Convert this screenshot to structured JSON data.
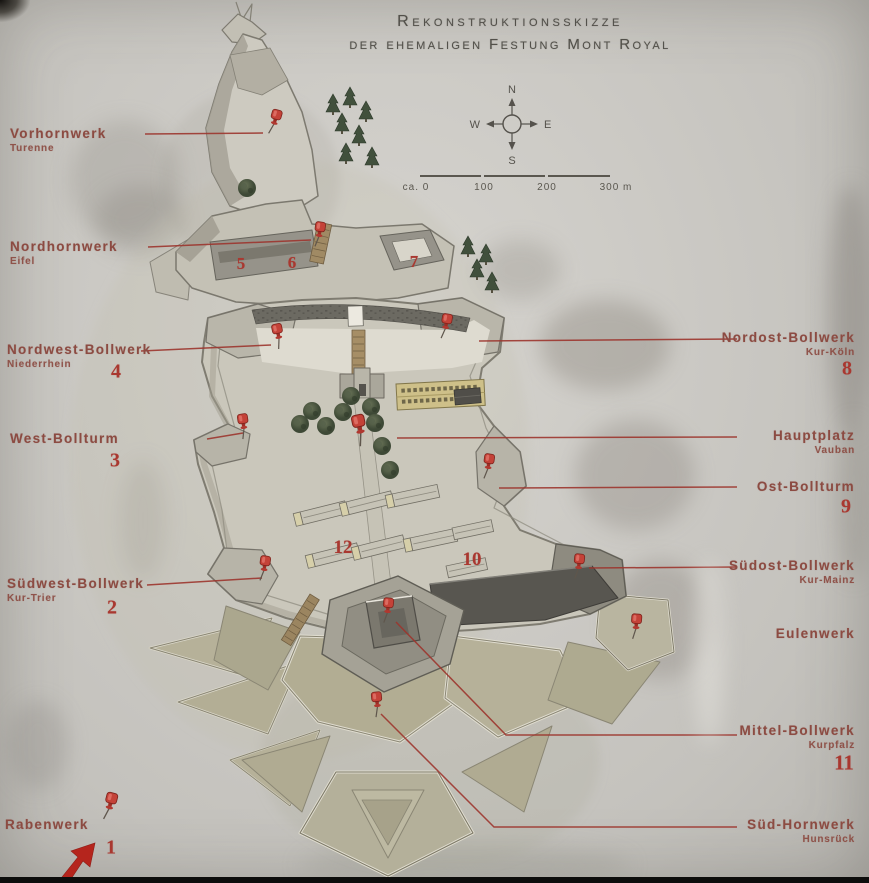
{
  "title": {
    "line1": "Rekonstruktionsskizze",
    "line2": "der ehemaligen Festung Mont Royal"
  },
  "compass": {
    "n": "N",
    "e": "E",
    "s": "S",
    "w": "W"
  },
  "scale": {
    "labels": [
      "ca. 0",
      "100",
      "200",
      "300 m"
    ]
  },
  "colors": {
    "annotation_red": "#9c352d",
    "number_red": "#a93830",
    "label_brick": "#8c4b42",
    "pin_red": "#c43a2e",
    "ink": "#52504a"
  },
  "annotations": {
    "labels": [
      {
        "text": "Vorhornwerk",
        "sub": "Turenne",
        "side": "left",
        "x": 10,
        "y": 126
      },
      {
        "text": "Nordhornwerk",
        "sub": "Eifel",
        "side": "left",
        "x": 10,
        "y": 239
      },
      {
        "text": "Nordwest-Bollwerk",
        "sub": "Niederrhein",
        "side": "left",
        "x": 7,
        "y": 342
      },
      {
        "text": "West-Bollturm",
        "sub": "",
        "side": "left",
        "x": 10,
        "y": 431
      },
      {
        "text": "Südwest-Bollwerk",
        "sub": "Kur-Trier",
        "side": "left",
        "x": 7,
        "y": 576
      },
      {
        "text": "Rabenwerk",
        "sub": "",
        "side": "left",
        "x": 5,
        "y": 817
      },
      {
        "text": "Nordost-Bollwerk",
        "sub": "Kur-Köln",
        "side": "right",
        "x": 855,
        "y": 330
      },
      {
        "text": "Hauptplatz",
        "sub": "Vauban",
        "side": "right",
        "x": 855,
        "y": 428
      },
      {
        "text": "Ost-Bollturm",
        "sub": "",
        "side": "right",
        "x": 855,
        "y": 479
      },
      {
        "text": "Südost-Bollwerk",
        "sub": "Kur-Mainz",
        "side": "right",
        "x": 855,
        "y": 558
      },
      {
        "text": "Eulenwerk",
        "sub": "",
        "side": "right",
        "x": 855,
        "y": 626
      },
      {
        "text": "Mittel-Bollwerk",
        "sub": "Kurpfalz",
        "side": "right",
        "x": 855,
        "y": 723
      },
      {
        "text": "Süd-Hornwerk",
        "sub": "Hunsrück",
        "side": "right",
        "x": 855,
        "y": 817
      }
    ],
    "numbers": [
      {
        "value": "1",
        "x": 111,
        "y": 848,
        "size": 20
      },
      {
        "value": "2",
        "x": 112,
        "y": 608,
        "size": 20
      },
      {
        "value": "3",
        "x": 115,
        "y": 461,
        "size": 20
      },
      {
        "value": "4",
        "x": 116,
        "y": 372,
        "size": 20
      },
      {
        "value": "5",
        "x": 241,
        "y": 264,
        "size": 17
      },
      {
        "value": "6",
        "x": 292,
        "y": 263,
        "size": 17
      },
      {
        "value": "7",
        "x": 414,
        "y": 262,
        "size": 17
      },
      {
        "value": "8",
        "x": 847,
        "y": 369,
        "size": 20
      },
      {
        "value": "9",
        "x": 846,
        "y": 507,
        "size": 20
      },
      {
        "value": "10",
        "x": 472,
        "y": 560,
        "size": 19
      },
      {
        "value": "11",
        "x": 844,
        "y": 763,
        "size": 21
      },
      {
        "value": "12",
        "x": 343,
        "y": 548,
        "size": 19
      }
    ],
    "leaders": [
      [
        [
          145,
          134
        ],
        [
          263,
          133
        ]
      ],
      [
        [
          148,
          247
        ],
        [
          311,
          240
        ]
      ],
      [
        [
          141,
          351
        ],
        [
          271,
          345
        ]
      ],
      [
        [
          207,
          439
        ],
        [
          243,
          433
        ]
      ],
      [
        [
          147,
          585
        ],
        [
          262,
          578
        ]
      ],
      [
        [
          479,
          341
        ],
        [
          737,
          339
        ]
      ],
      [
        [
          397,
          438
        ],
        [
          737,
          437
        ]
      ],
      [
        [
          499,
          488
        ],
        [
          737,
          487
        ]
      ],
      [
        [
          589,
          568
        ],
        [
          737,
          567
        ]
      ],
      [
        [
          396,
          622
        ],
        [
          506,
          735
        ],
        [
          737,
          735
        ]
      ],
      [
        [
          381,
          714
        ],
        [
          494,
          827
        ],
        [
          737,
          827
        ]
      ]
    ],
    "pins": [
      {
        "x": 278,
        "y": 110,
        "r": 16
      },
      {
        "x": 321,
        "y": 222,
        "r": 8
      },
      {
        "x": 276,
        "y": 324,
        "r": -12
      },
      {
        "x": 242,
        "y": 414,
        "r": -8
      },
      {
        "x": 448,
        "y": 314,
        "r": 10
      },
      {
        "x": 357,
        "y": 415,
        "r": -12,
        "s": 1.25
      },
      {
        "x": 490,
        "y": 454,
        "r": 8
      },
      {
        "x": 266,
        "y": 556,
        "r": 8
      },
      {
        "x": 580,
        "y": 554,
        "r": 6
      },
      {
        "x": 637,
        "y": 614,
        "r": 4
      },
      {
        "x": 389,
        "y": 598,
        "r": 6
      },
      {
        "x": 376,
        "y": 692,
        "r": -6
      },
      {
        "x": 113,
        "y": 793,
        "r": 14,
        "s": 1.1
      }
    ]
  }
}
